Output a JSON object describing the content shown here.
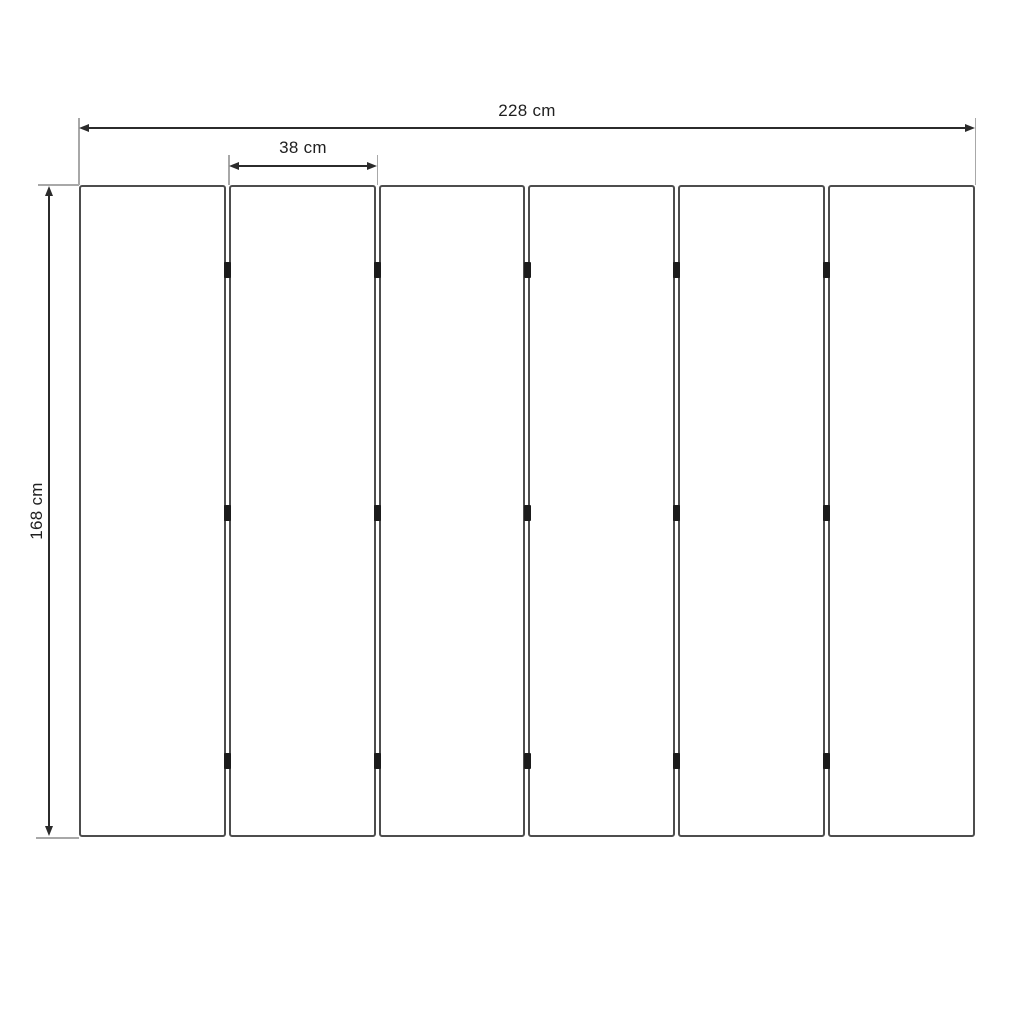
{
  "diagram": {
    "type": "technical-dimension-drawing",
    "labels": {
      "total_width": "228 cm",
      "single_panel_width": "38 cm",
      "height": "168 cm"
    },
    "panel_count": 6,
    "joint_count": 5,
    "hinges_per_joint": 3,
    "colors": {
      "background": "#ffffff",
      "panel_border": "#4d4d4d",
      "dimension_line": "#2b2b2b",
      "extension_line": "#a8a8a8",
      "hinge": "#1b1b1b",
      "label_text": "#1f1f1f"
    }
  }
}
